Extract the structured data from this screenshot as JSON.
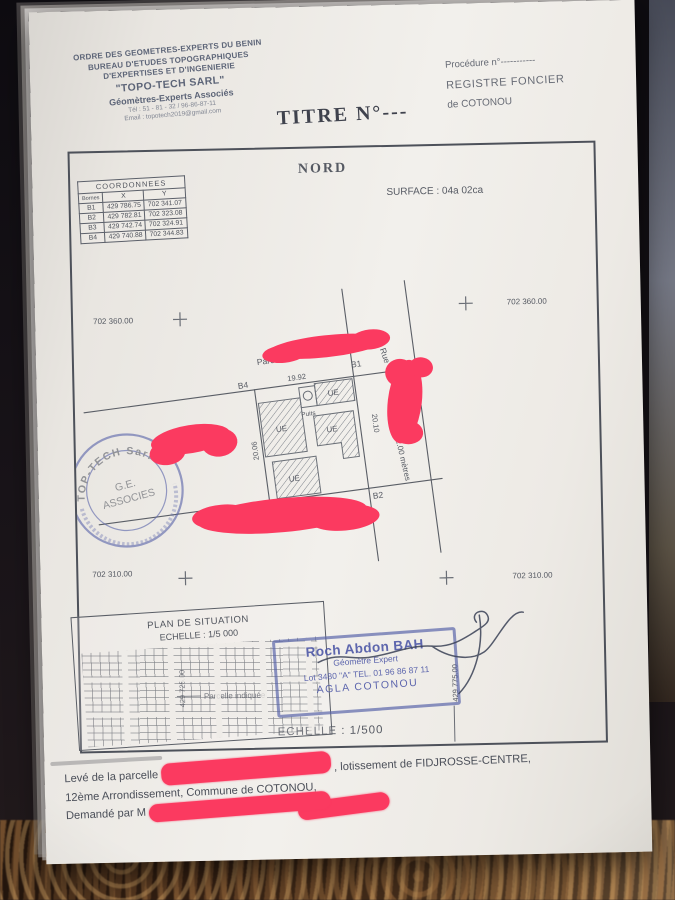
{
  "letterhead": {
    "line1": "ORDRE DES GEOMETRES-EXPERTS DU BENIN",
    "line2": "BUREAU D'ETUDES TOPOGRAPHIQUES",
    "line3": "D'EXPERTISES ET D'INGENIERIE",
    "company": "\"TOPO-TECH SARL\"",
    "subtitle": "Géomètres-Experts Associés",
    "phone": "Tél : 51 - 81 - 32 / 96-86-87-11",
    "email": "Email : topotech2019@gmail.com"
  },
  "registry": {
    "procedure": "Procédure n°-----------",
    "register": "REGISTRE FONCIER",
    "city": "de COTONOU"
  },
  "title": "TITRE N°---",
  "north_label": "NORD",
  "surface_label": "SURFACE :   04a  02ca",
  "coordinates_table": {
    "caption": "COORDONNEES",
    "col_bornes": "Bornes",
    "col_x": "X",
    "col_y": "Y",
    "rows": [
      {
        "borne": "B1",
        "x": "429 786.75",
        "y": "702 341.07"
      },
      {
        "borne": "B2",
        "x": "429 782.81",
        "y": "702 323.08"
      },
      {
        "borne": "B3",
        "x": "429 742.74",
        "y": "702 324.91"
      },
      {
        "borne": "B4",
        "x": "429 740.88",
        "y": "702 344.83"
      }
    ]
  },
  "grid_labels": {
    "top_left": "702 360.00",
    "top_right": "702 360.00",
    "bottom_left": "702 310.00",
    "bottom_right": "702 310.00",
    "x_left": "429 725.00",
    "x_right": "429 775.00"
  },
  "plan": {
    "parcel_top_label": "Parcelle \"I\"",
    "parcel_bottom_label": "Parcelle \"n\"",
    "corner_b1": "B1",
    "corner_b2": "B2",
    "corner_b3": "B3",
    "corner_b4": "B4",
    "dim_top": "19.92",
    "dim_right": "20.10",
    "dim_left": "20.06",
    "dim_bottom": "20.30",
    "building_label": "UE",
    "well_label": "Puits",
    "street_label_1": "Rue",
    "street_label_2": "de 12.00 mètres"
  },
  "round_stamp": {
    "arc_top": "TOP-TECH Sarl",
    "center_line1": "G.E.",
    "center_line2": "ASSOCIES"
  },
  "situation": {
    "title": "PLAN DE SITUATION",
    "scale": "ECHELLE : 1/5 000",
    "pointer": "Parcelle indiquée"
  },
  "surveyor_stamp": {
    "name": "Roch Abdon BAH",
    "role": "Géomètre Expert",
    "address": "Lot 3480 \"A\" TEL. 01 96 86 87 11",
    "city": "AGLA COTONOU"
  },
  "scale_label": "ECHELLE : 1/500",
  "footer": {
    "line1_a": "Levé de la parcelle",
    "line1_b": ", lotissement de FIDJROSSE-CENTRE,",
    "line2": "12ème Arrondissement, Commune de COTONOU,",
    "line3": "Demandé par M"
  },
  "colors": {
    "redaction": "#fb3a60",
    "stamp_blue": "#5661a8",
    "ink": "#4c5058"
  }
}
